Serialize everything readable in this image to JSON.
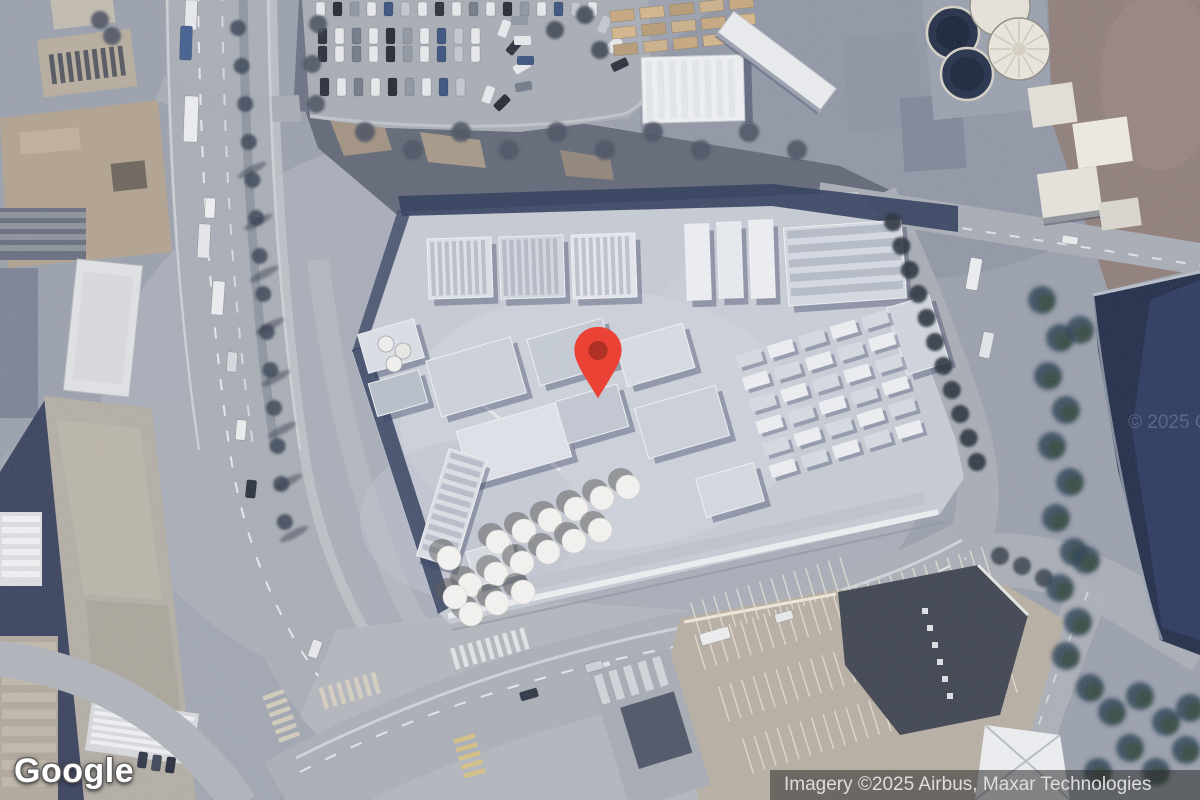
{
  "map": {
    "google_logo": "Google",
    "attribution": "Imagery ©2025 Airbus, Maxar Technologies",
    "watermark": "© 2025 Go",
    "marker": {
      "color": "#EA4335",
      "inner_color": "#B03126"
    },
    "colors": {
      "attribution_bg": "rgba(43,43,43,0.55)",
      "attribution_text": "#DEDEDE",
      "logo_text": "#FFFFFF",
      "pond": "#1E2946",
      "tree": "#33483F"
    }
  }
}
